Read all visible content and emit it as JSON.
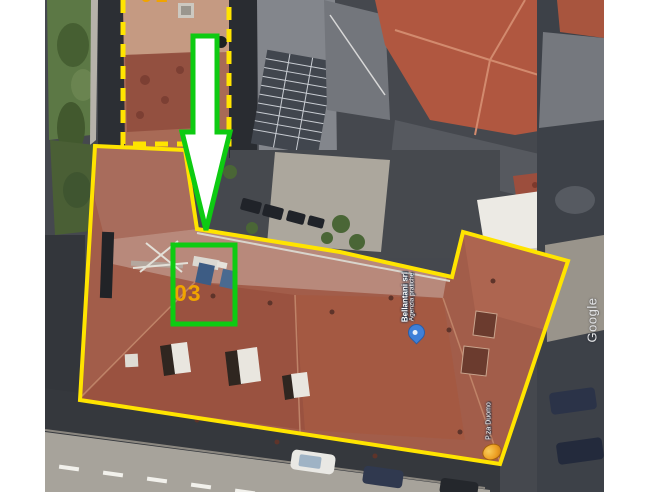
{
  "page": {
    "background": "#ffffff"
  },
  "map": {
    "watermark": "Google",
    "poi": {
      "business_label_line1": "Bellantani srl",
      "business_label_line2": "Agenzia pratiche",
      "street_label": "P.za Duomo"
    },
    "markers": {
      "business_marker": "blue-place-marker",
      "street_marker": "orange-landmark-icon"
    }
  },
  "annotations": {
    "unit_label": "03",
    "top_partial_label": "01",
    "colors": {
      "boundary_yellow": "#ffe400",
      "highlight_green": "#0ecb12",
      "label_amber": "#f0a400",
      "arrow_fill": "#ffffff"
    }
  }
}
